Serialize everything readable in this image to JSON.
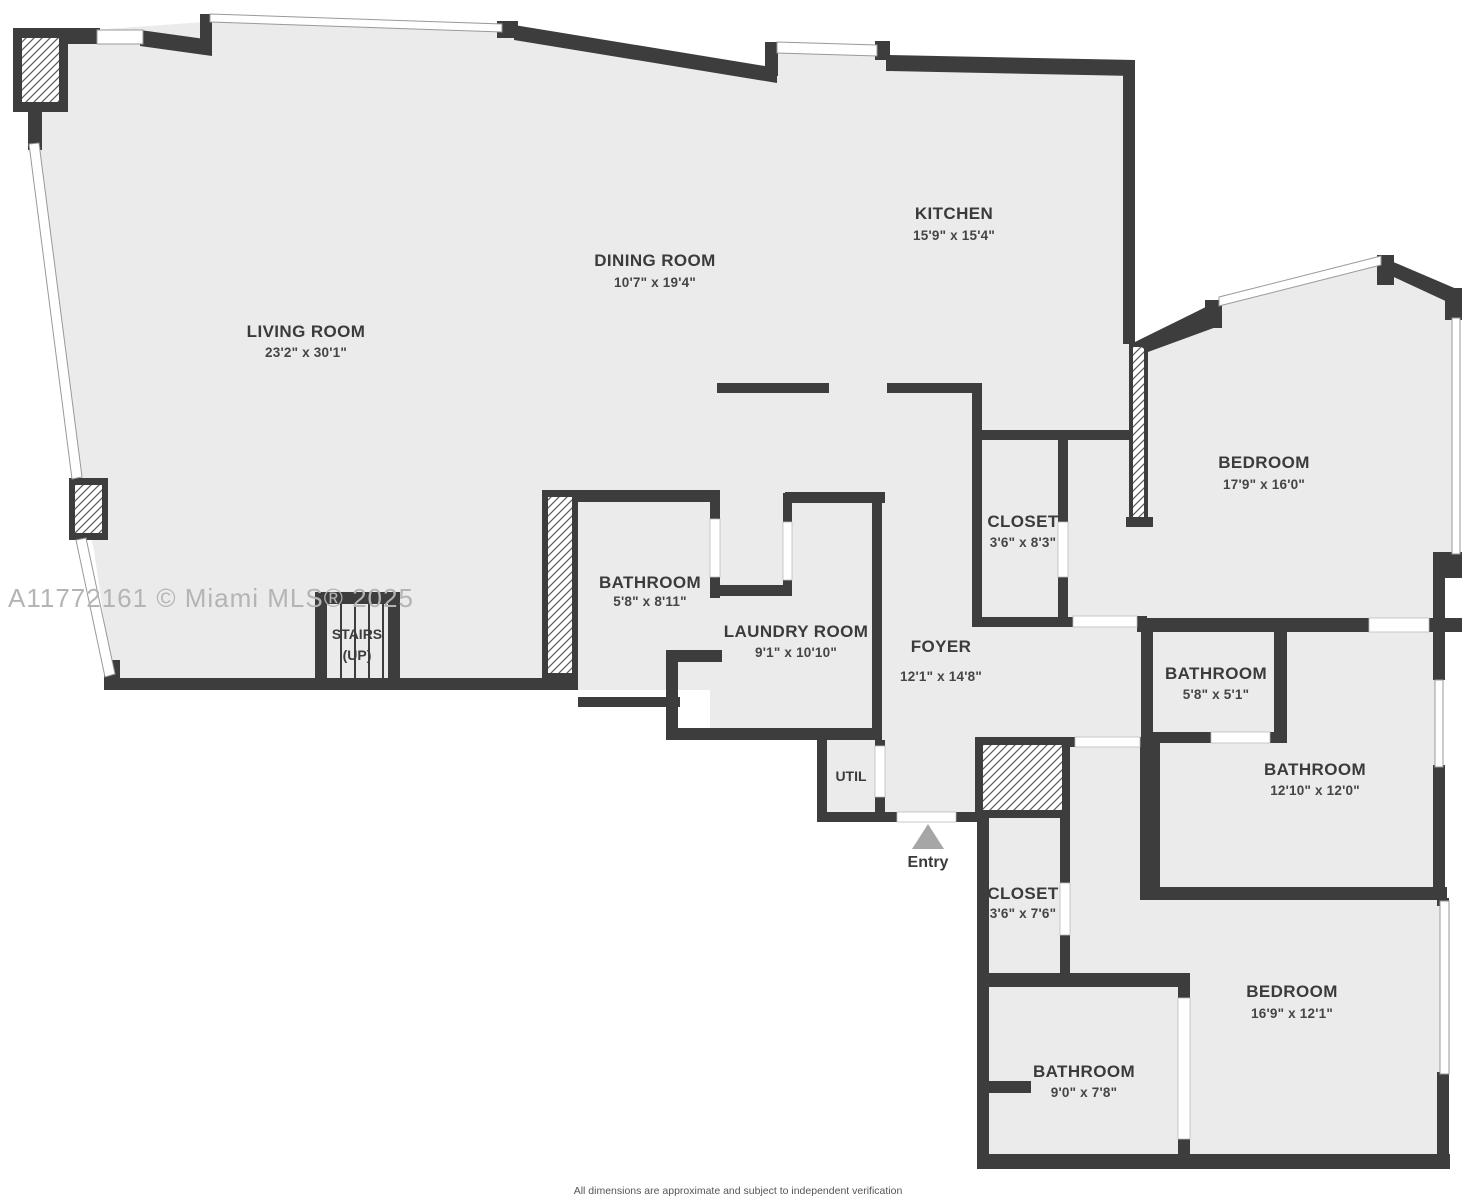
{
  "watermark": "A11772161 © Miami MLS® 2025",
  "disclaimer": "All dimensions are approximate and subject to independent verification",
  "entry_label": "Entry",
  "colors": {
    "wall": "#3d3d3d",
    "floor": "#ebebeb",
    "window_line": "#999999",
    "hatch_line": "#5a5a5a",
    "entry_arrow": "#a6a6a6",
    "watermark_text": "#b4b4b4",
    "disclaimer_text": "#555555"
  },
  "rooms": [
    {
      "name": "LIVING ROOM",
      "dims": "23'2\" x 30'1\""
    },
    {
      "name": "DINING ROOM",
      "dims": "10'7\" x 19'4\""
    },
    {
      "name": "KITCHEN",
      "dims": "15'9\" x 15'4\""
    },
    {
      "name": "BEDROOM",
      "dims": "17'9\" x 16'0\""
    },
    {
      "name": "CLOSET",
      "dims": "3'6\" x 8'3\""
    },
    {
      "name": "BATHROOM",
      "dims": "5'8\" x 8'11\""
    },
    {
      "name": "LAUNDRY ROOM",
      "dims": "9'1\" x 10'10\""
    },
    {
      "name": "FOYER",
      "dims": "12'1\" x 14'8\""
    },
    {
      "name": "BATHROOM",
      "dims": "5'8\" x 5'1\""
    },
    {
      "name": "BATHROOM",
      "dims": "12'10\" x 12'0\""
    },
    {
      "name": "CLOSET",
      "dims": "3'6\" x 7'6\""
    },
    {
      "name": "BEDROOM",
      "dims": "16'9\" x 12'1\""
    },
    {
      "name": "BATHROOM",
      "dims": "9'0\" x 7'8\""
    },
    {
      "name": "STAIRS",
      "dims": "(UP)"
    },
    {
      "name": "UTIL",
      "dims": ""
    }
  ]
}
